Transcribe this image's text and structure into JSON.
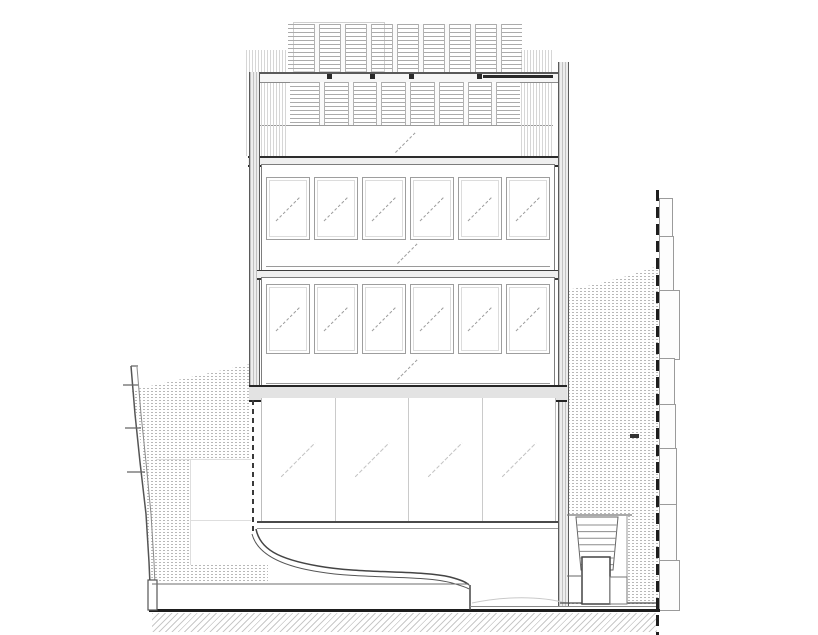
{
  "drawing": {
    "kind": "building-elevation-section",
    "palette": {
      "ink": "#1e1e1e",
      "mid": "#777777",
      "light": "#b8b8b8",
      "faint": "#dedede",
      "column_fill": "#ededed",
      "slab_fill": "#efefef",
      "stipple_dot": "#9a9a9a",
      "ground_hatch": "#c9c9c9",
      "background": "#ffffff"
    },
    "roof": {
      "posts_upper": 8,
      "posts_lower": 7
    },
    "facade": {
      "floors": [
        {
          "windows": 6
        },
        {
          "windows": 6
        }
      ],
      "ground_panels": 4
    },
    "site": {
      "stair": {
        "treads": 7
      },
      "neighbor_right_segments": [
        {
          "y": 198,
          "h": 38,
          "w": 12
        },
        {
          "y": 236,
          "h": 54,
          "w": 13
        },
        {
          "y": 290,
          "h": 68,
          "w": 19
        },
        {
          "y": 358,
          "h": 46,
          "w": 14
        },
        {
          "y": 404,
          "h": 44,
          "w": 15
        },
        {
          "y": 448,
          "h": 56,
          "w": 16
        },
        {
          "y": 504,
          "h": 56,
          "w": 16
        },
        {
          "y": 560,
          "h": 49,
          "w": 19
        }
      ]
    }
  }
}
